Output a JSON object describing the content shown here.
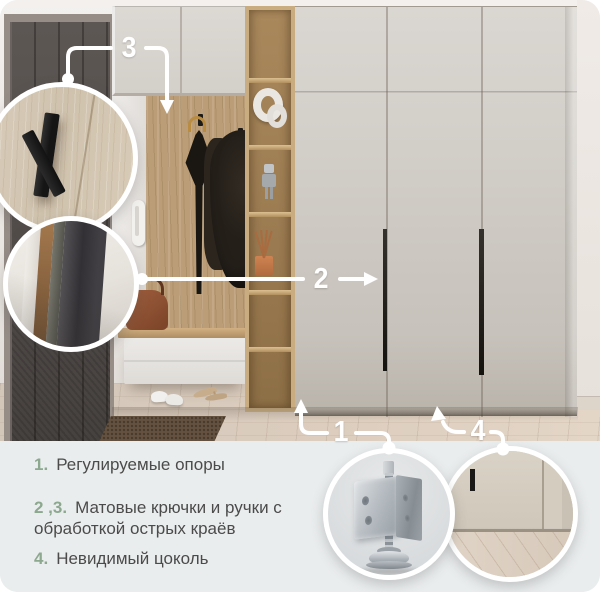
{
  "card": {
    "bg": "#ffffff",
    "panel_bg": "#eaedee",
    "accent_green": "#8ca88e",
    "text_color": "#4b4b4b",
    "callout_color": "#ffffff"
  },
  "callouts": {
    "supports": "1",
    "handles": "2",
    "hooks": "3",
    "plinth": "4"
  },
  "features": [
    {
      "num": "1.",
      "text": "Регулируемые опоры"
    },
    {
      "num": "2 ,3.",
      "text": "Матовые крючки и ручки с обработкой острых краёв"
    },
    {
      "num": "4.",
      "text": "Невидимый цоколь"
    }
  ]
}
